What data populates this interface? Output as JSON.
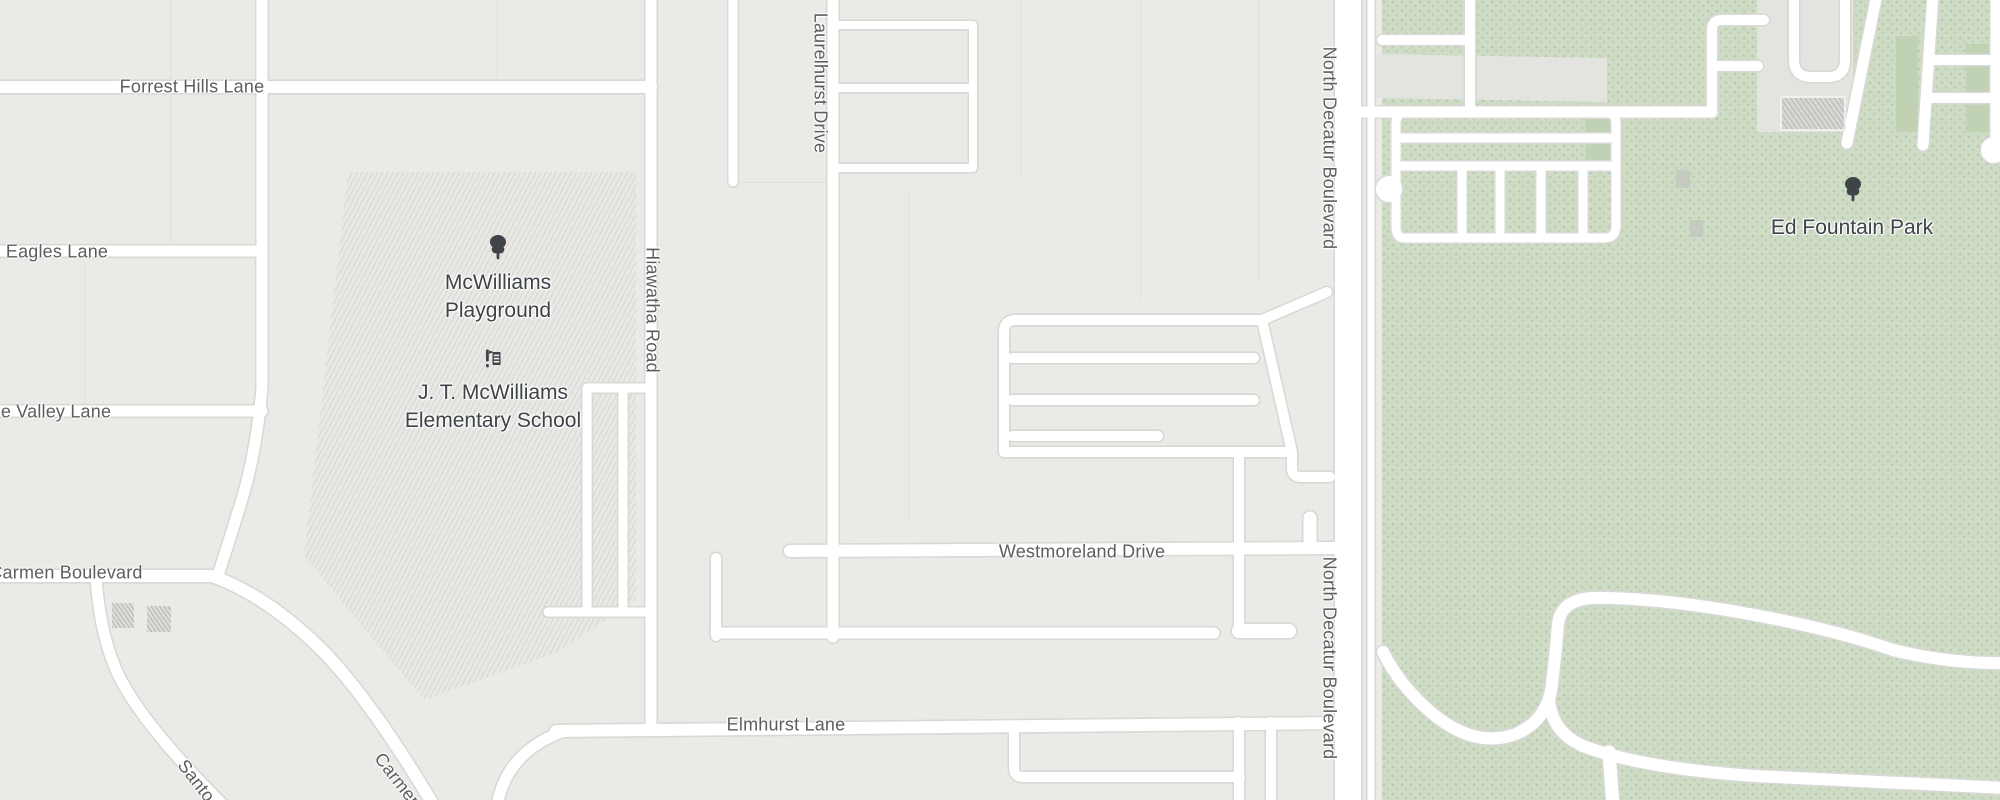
{
  "map": {
    "colors": {
      "background": "#ebeae7",
      "road_fill": "#ffffff",
      "road_casing": "#d8d8d5",
      "park_green": "#cedcc5",
      "street_label": "#5b5e61",
      "poi_label": "#3e4347",
      "poi_icon": "#404448"
    },
    "streets": [
      {
        "label": "Forrest Hills Lane"
      },
      {
        "label": "Eagles Lane"
      },
      {
        "label": "e Valley Lane"
      },
      {
        "label": "Carmen Boulevard"
      },
      {
        "label": "Westmoreland Drive"
      },
      {
        "label": "Elmhurst Lane"
      },
      {
        "label": "Hiawatha Road"
      },
      {
        "label": "Laurelhurst Drive"
      },
      {
        "label": "North Decatur Boulevard"
      },
      {
        "label": "North Decatur Boulevard"
      },
      {
        "label": "Santo"
      },
      {
        "label": "Carmen"
      }
    ],
    "pois": {
      "playground": {
        "line1": "McWilliams",
        "line2": "Playground",
        "icon": "tree"
      },
      "school": {
        "line1": "J. T. McWilliams",
        "line2": "Elementary School",
        "icon": "school"
      },
      "park": {
        "line1": "Ed Fountain Park",
        "icon": "tree"
      }
    }
  }
}
